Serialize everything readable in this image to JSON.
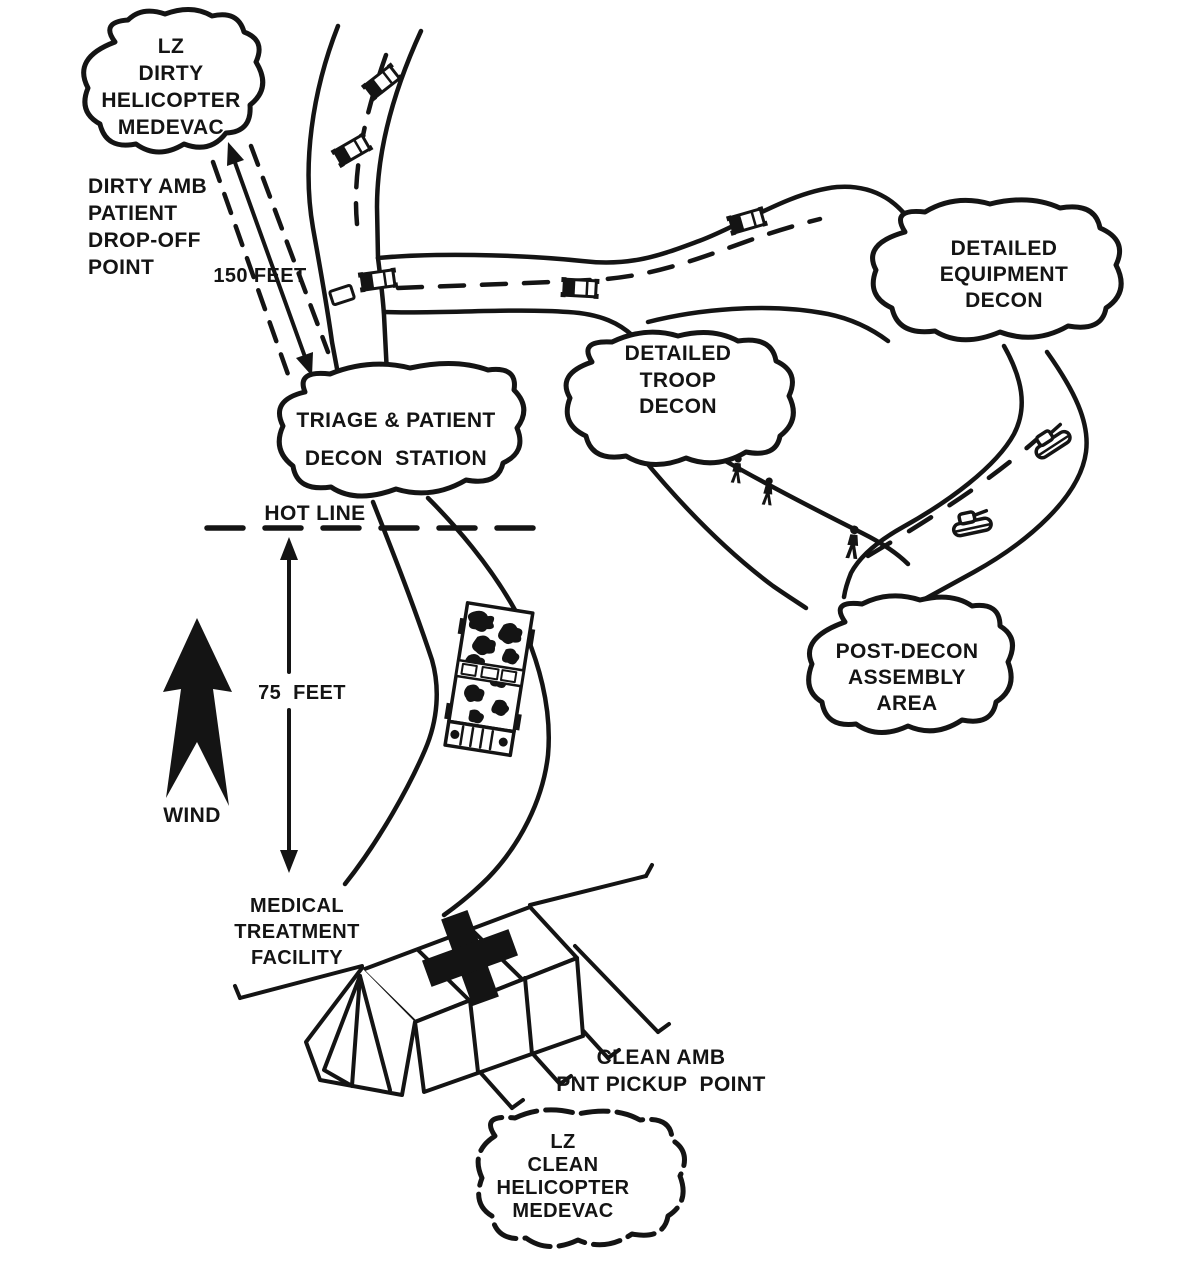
{
  "diagram": {
    "description": "Patient decontamination site layout sketch",
    "colors": {
      "ink": "#141414",
      "background": "#ffffff"
    },
    "icons": [
      "cloud-boundary",
      "road",
      "dashed-hot-line",
      "wind-arrow",
      "distance-arrow",
      "medical-tent-cross",
      "truck",
      "tank",
      "person-walking",
      "camouflage-ambulance"
    ],
    "labels": {
      "lz_dirty": "LZ\nDIRTY\nHELICOPTER\nMEDEVAC",
      "dirty_amb": "DIRTY AMB\nPATIENT\nDROP-OFF\nPOINT",
      "distance_150": "150 FEET",
      "triage": "TRIAGE & PATIENT\nDECON  STATION",
      "hot_line": "HOT LINE",
      "distance_75": "75  FEET",
      "wind": "WIND",
      "mtf": "MEDICAL\nTREATMENT\nFACILITY",
      "clean_amb": "CLEAN AMB\nPNT PICKUP  POINT",
      "lz_clean": "LZ\nCLEAN\nHELICOPTER\nMEDEVAC",
      "troop_decon": "DETAILED\nTROOP\nDECON",
      "equipment_decon": "DETAILED\nEQUIPMENT\nDECON",
      "post_decon": "POST-DECON\nASSEMBLY\nAREA"
    }
  }
}
